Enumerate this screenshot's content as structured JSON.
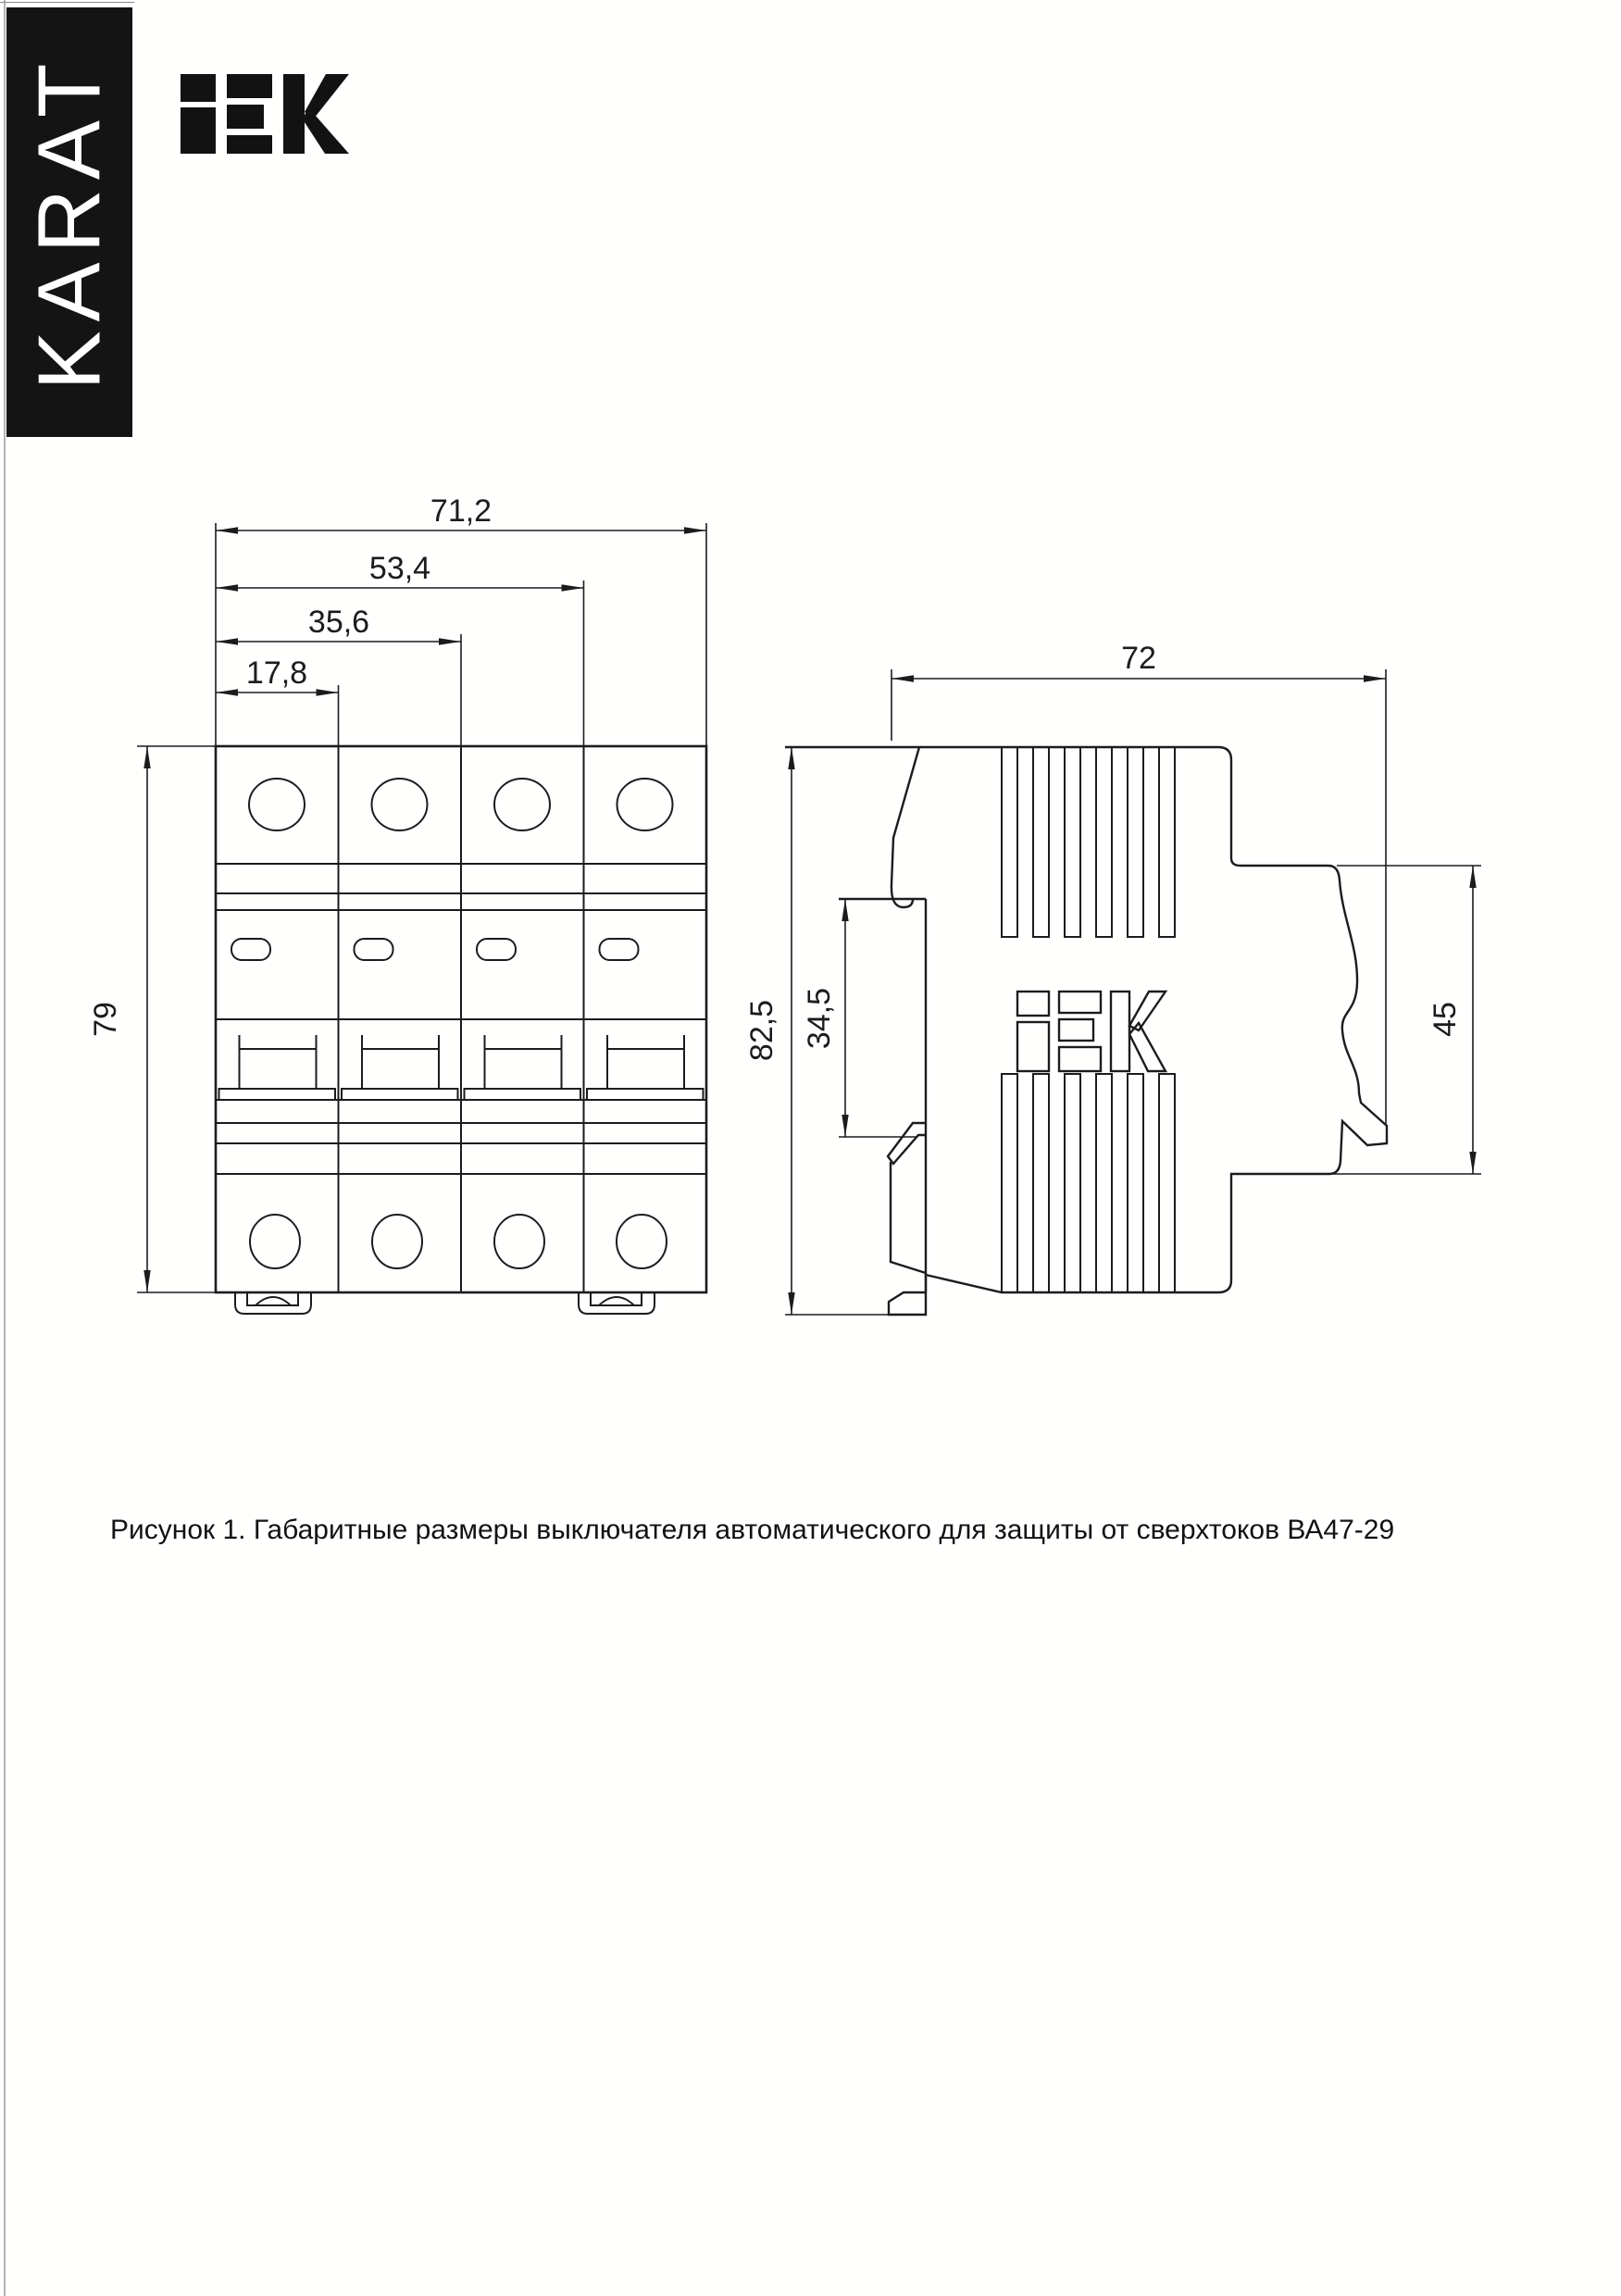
{
  "branding": {
    "banner_text": "KARAT",
    "banner_bg": "#141414",
    "banner_text_color": "#ffffff",
    "logo_text": "IEK"
  },
  "figure": {
    "caption": "Рисунок 1. Габаритные размеры выключателя автоматического для защиты от сверхтоков ВА47-29"
  },
  "front_view": {
    "description": "front view, 4-pole circuit breaker",
    "poles": 4,
    "dims": {
      "total_width": "71,2",
      "three_pole": "53,4",
      "two_pole": "35,6",
      "one_pole": "17,8",
      "height": "79"
    }
  },
  "side_view": {
    "description": "side view with DIN rail profile",
    "logo_text": "IEK",
    "dims": {
      "depth": "72",
      "total_height": "82,5",
      "rail_recess": "34,5",
      "front_face": "45"
    }
  },
  "line_color": "#1c1c1c"
}
